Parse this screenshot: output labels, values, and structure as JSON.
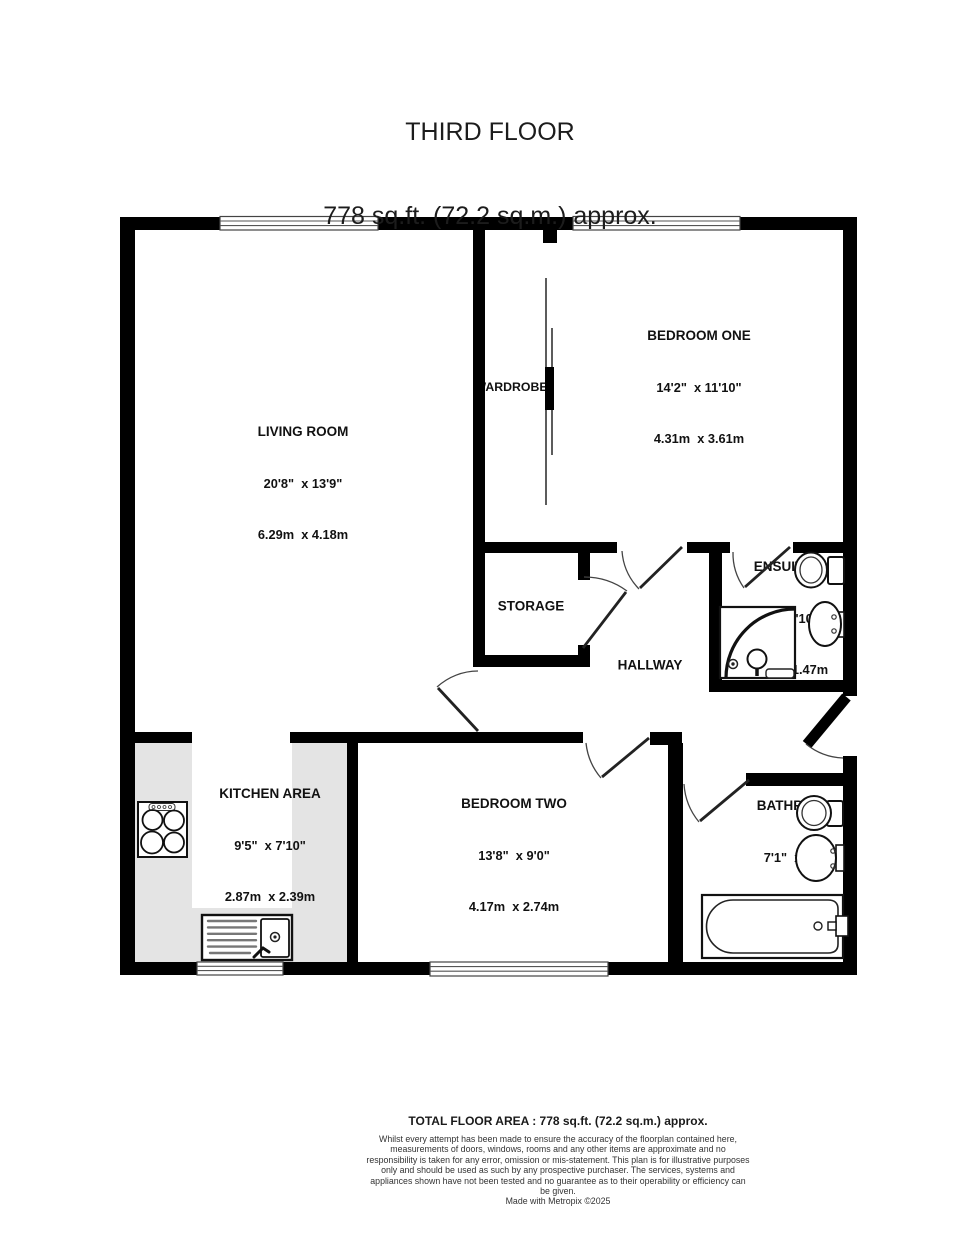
{
  "title": {
    "floor": "THIRD FLOOR",
    "area": "778 sq.ft. (72.2 sq.m.) approx."
  },
  "rooms": {
    "living_room": {
      "name": "LIVING ROOM",
      "imperial": "20'8\"  x 13'9\"",
      "metric": "6.29m  x 4.18m"
    },
    "bedroom_one": {
      "name": "BEDROOM ONE",
      "imperial": "14'2\"  x 11'10\"",
      "metric": "4.31m  x 3.61m"
    },
    "bedroom_two": {
      "name": "BEDROOM TWO",
      "imperial": "13'8\"  x 9'0\"",
      "metric": "4.17m  x 2.74m"
    },
    "kitchen": {
      "name": "KITCHEN AREA",
      "imperial": "9'5\"  x 7'10\"",
      "metric": "2.87m  x 2.39m"
    },
    "bathroom": {
      "name": "BATHROOM",
      "imperial": "7'1\"  x 6'5\"",
      "metric": "2.17m  x 1.96m"
    },
    "ensuite": {
      "name": "ENSUITE",
      "imperial": "5'3\"  x 4'10\"",
      "metric": "1.61m  x 1.47m"
    },
    "storage": {
      "name": "STORAGE"
    },
    "hallway": {
      "name": "HALLWAY"
    },
    "wardrobe": {
      "name": "WARDROBE"
    }
  },
  "footer": {
    "total": "TOTAL FLOOR AREA : 778 sq.ft. (72.2 sq.m.) approx.",
    "disclaimer": "Whilst every attempt has been made to ensure the accuracy of the floorplan contained here, measurements of doors, windows, rooms and any other items are approximate and no responsibility is taken for any error, omission or mis-statement. This plan is for illustrative purposes only and should be used as such by any prospective purchaser. The services, systems and appliances shown have not been tested and no guarantee as to their operability or efficiency can be given.",
    "credit": "Made with Metropix ©2025"
  },
  "colors": {
    "wall": "#000000",
    "counter": "#e4e4e4",
    "text": "#1a1a1a"
  }
}
